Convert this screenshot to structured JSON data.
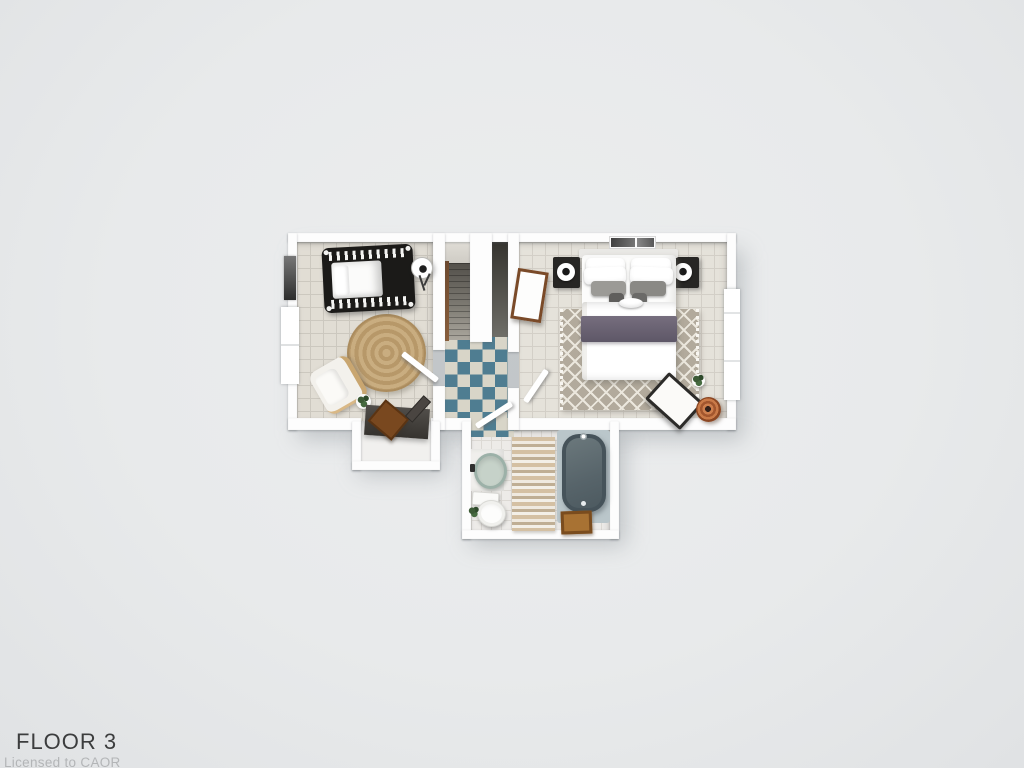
{
  "meta": {
    "title": "FLOOR 3",
    "license": "Licensed to CAOR"
  },
  "palette": {
    "background": "#e8eaeb",
    "wall": "#fdfdfd",
    "checker_teal": "#4f7d91",
    "checker_cream": "#d8d5c8",
    "jute_rug": "#bd9f72",
    "trellis_rug": "#b2aa9c",
    "blanket_purple": "#685f71",
    "tub_slate": "#57646a",
    "tub_deck": "#bac6ca",
    "copper_basket": "#b0653b",
    "wood_brown": "#79481f",
    "stair_gray": "#7d7a72",
    "crib_black": "#1b1a18"
  },
  "floor_plan": {
    "view": "3d-top-down-render",
    "rooms": [
      {
        "name": "nursery",
        "floor": "beige-tile",
        "items": [
          "crib",
          "floor-lamp",
          "round-jute-rug",
          "lounge-chair",
          "potted-plant",
          "desk-nook-with-wood-crate"
        ]
      },
      {
        "name": "stair-hall",
        "floor": "teal-white-checkerboard",
        "items": [
          "staircase",
          "wood-railing",
          "stairwell-void",
          "leaning-mirror"
        ]
      },
      {
        "name": "master-bedroom",
        "floor": "beige-tile",
        "items": [
          "double-bed",
          "white-pillows",
          "gray-pillows",
          "purple-blanket",
          "nightstand-left",
          "nightstand-right",
          "sphere-table-lamps",
          "trellis-rug",
          "bench",
          "copper-basket",
          "plant",
          "wall-art"
        ]
      },
      {
        "name": "bathroom",
        "floor": "white-tile",
        "items": [
          "bathtub",
          "sink-vanity",
          "toilet",
          "striped-runner-rug",
          "wood-stool",
          "plant"
        ]
      }
    ],
    "openings": [
      "nursery-door",
      "bedroom-door",
      "bathroom-door",
      "left-wall-windows",
      "right-wall-window",
      "dark-window-upper-left"
    ]
  }
}
